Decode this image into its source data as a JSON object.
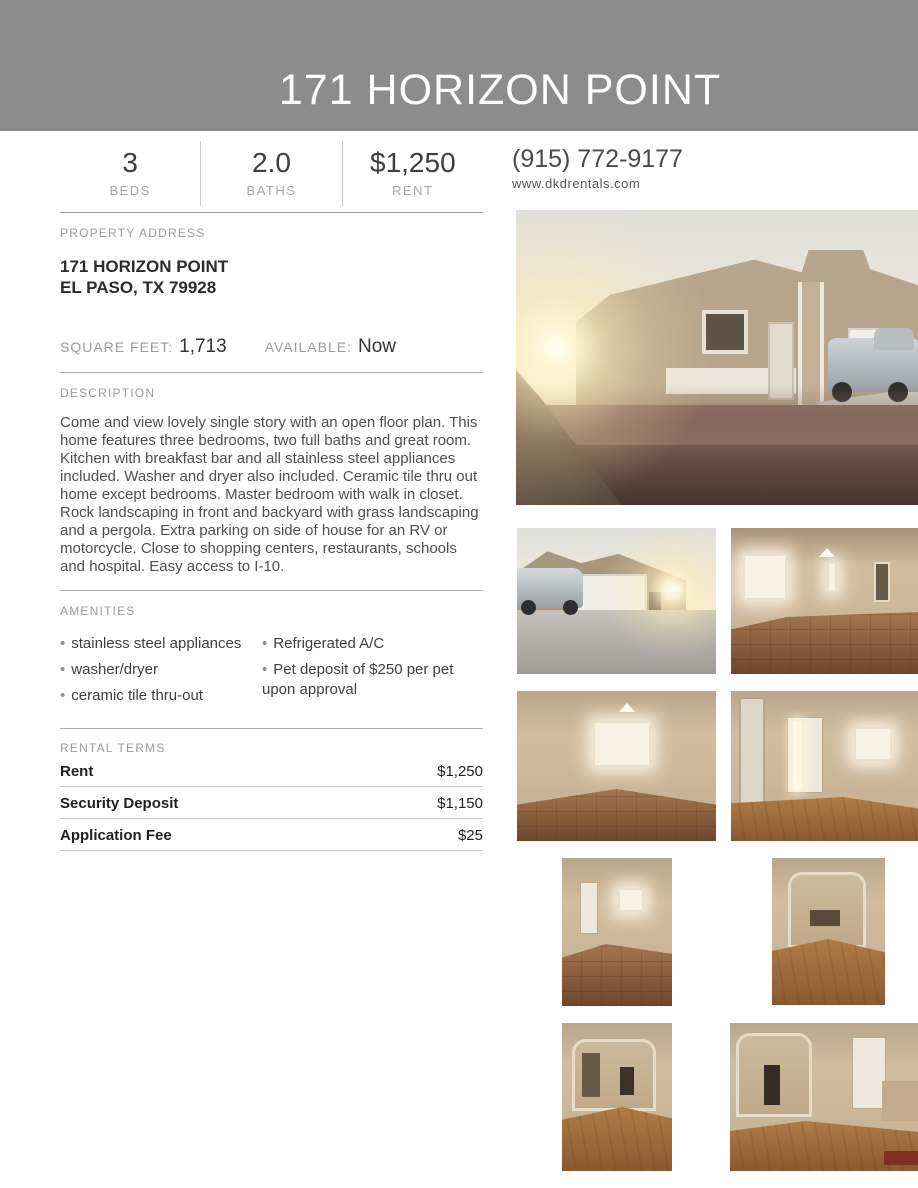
{
  "colors": {
    "header_bg": "#8c8c8c",
    "header_text": "#ffffff"
  },
  "header": {
    "title": "171 HORIZON POINT"
  },
  "stats": [
    {
      "value": "3",
      "label": "BEDS"
    },
    {
      "value": "2.0",
      "label": "BATHS"
    },
    {
      "value": "$1,250",
      "label": "RENT"
    }
  ],
  "contact": {
    "phone": "(915) 772-9177",
    "website": "www.dkdrentals.com"
  },
  "property": {
    "section_label": "PROPERTY ADDRESS",
    "address_line1": "171 HORIZON POINT",
    "address_line2": "EL PASO, TX 79928",
    "square_feet_label": "SQUARE FEET:",
    "square_feet": "1,713",
    "available_label": "AVAILABLE:",
    "available": "Now"
  },
  "description": {
    "section_label": "DESCRIPTION",
    "text": "Come and view lovely single story with an open floor plan. This home features three bedrooms, two full baths and great room. Kitchen with breakfast bar and all stainless steel appliances included. Washer and dryer also included. Ceramic tile thru out home except bedrooms. Master bedroom with walk in closet. Rock landscaping in front and backyard with grass landscaping and a pergola. Extra parking on side of house for an RV or motorcycle. Close to shopping centers, restaurants, schools and hospital. Easy access to I-10."
  },
  "amenities": {
    "section_label": "AMENITIES",
    "column1": [
      "stainless steel appliances",
      "washer/dryer",
      "ceramic tile thru-out"
    ],
    "column2": [
      "Refrigerated A/C",
      "Pet deposit of $250 per pet upon approval"
    ]
  },
  "rental_terms": {
    "section_label": "RENTAL TERMS",
    "rows": [
      {
        "label": "Rent",
        "value": "$1,250"
      },
      {
        "label": "Security Deposit",
        "value": "$1,150"
      },
      {
        "label": "Application Fee",
        "value": "$25"
      }
    ]
  },
  "photos": {
    "main": {
      "description": "Front exterior of tan stucco house at sunset with sun flare, rock landscaping and pickup truck"
    },
    "grid": [
      {
        "description": "Driveway with pickup truck and two-car garage in evening sun"
      },
      {
        "description": "Open living area with ceramic tile floor and bright window"
      },
      {
        "description": "Empty great room with bright window, ceiling lamp and tile floor"
      },
      {
        "description": "Entryway with white front door, window and wood-look floor"
      },
      {
        "description": "Room with tile floor, doorway and bright window"
      },
      {
        "description": "Wood-floor dining area seen through archway"
      },
      {
        "description": "Wood-floor hallway view toward living area"
      },
      {
        "description": "Wood-floor room with archway, pantry door and red mat"
      }
    ]
  }
}
